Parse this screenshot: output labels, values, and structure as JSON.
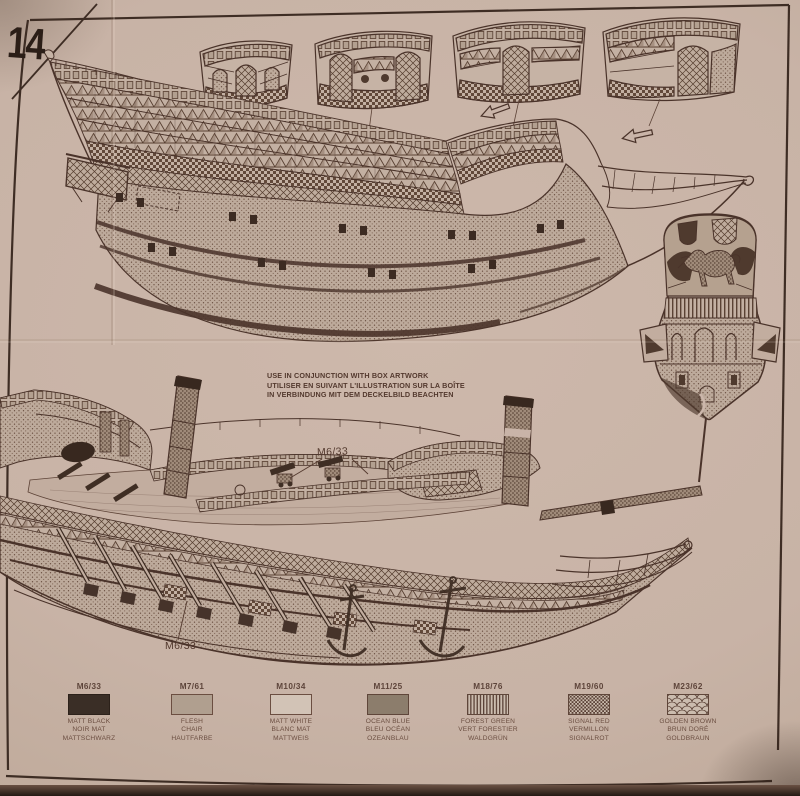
{
  "step": {
    "number": "14"
  },
  "note": {
    "lines": [
      "USE IN CONJUNCTION WITH BOX ARTWORK",
      "UTILISER EN SUIVANT L'ILLUSTRATION SUR LA BOÎTE",
      "IN VERBINDUNG MIT DEM DECKELBILD BEACHTEN"
    ]
  },
  "callouts": {
    "deck": "M6/33",
    "hull": "M6/33"
  },
  "legend": {
    "entries": [
      {
        "code": "M6/33",
        "swatch": "solid-black",
        "color": "#3a2e26",
        "names": [
          "MATT BLACK",
          "NOIR MAT",
          "MATTSCHWARZ"
        ]
      },
      {
        "code": "M7/61",
        "swatch": "solid-flesh",
        "color": "#b09f8f",
        "names": [
          "FLESH",
          "CHAIR",
          "HAUTFARBE"
        ]
      },
      {
        "code": "M10/34",
        "swatch": "outline-white",
        "color": "#d2c3b6",
        "names": [
          "MATT WHITE",
          "BLANC MAT",
          "MATTWEIS"
        ]
      },
      {
        "code": "M11/25",
        "swatch": "solid-gray",
        "color": "#8c7d6c",
        "names": [
          "OCEAN BLUE",
          "BLEU OCÉAN",
          "OZEANBLAU"
        ]
      },
      {
        "code": "M18/76",
        "swatch": "stripes",
        "color": "#5a4136",
        "names": [
          "FOREST GREEN",
          "VERT FORESTIER",
          "WALDGRÜN"
        ]
      },
      {
        "code": "M19/60",
        "swatch": "checker",
        "color": "#5a4136",
        "names": [
          "SIGNAL RED",
          "VERMILLON",
          "SIGNALROT"
        ]
      },
      {
        "code": "M23/62",
        "swatch": "scales",
        "color": "#5a4136",
        "names": [
          "GOLDEN BROWN",
          "BRUN DORÉ",
          "GOLDBRAUN"
        ]
      }
    ]
  },
  "colors": {
    "paper": "#c8b3a6",
    "ink": "#4a332a"
  }
}
